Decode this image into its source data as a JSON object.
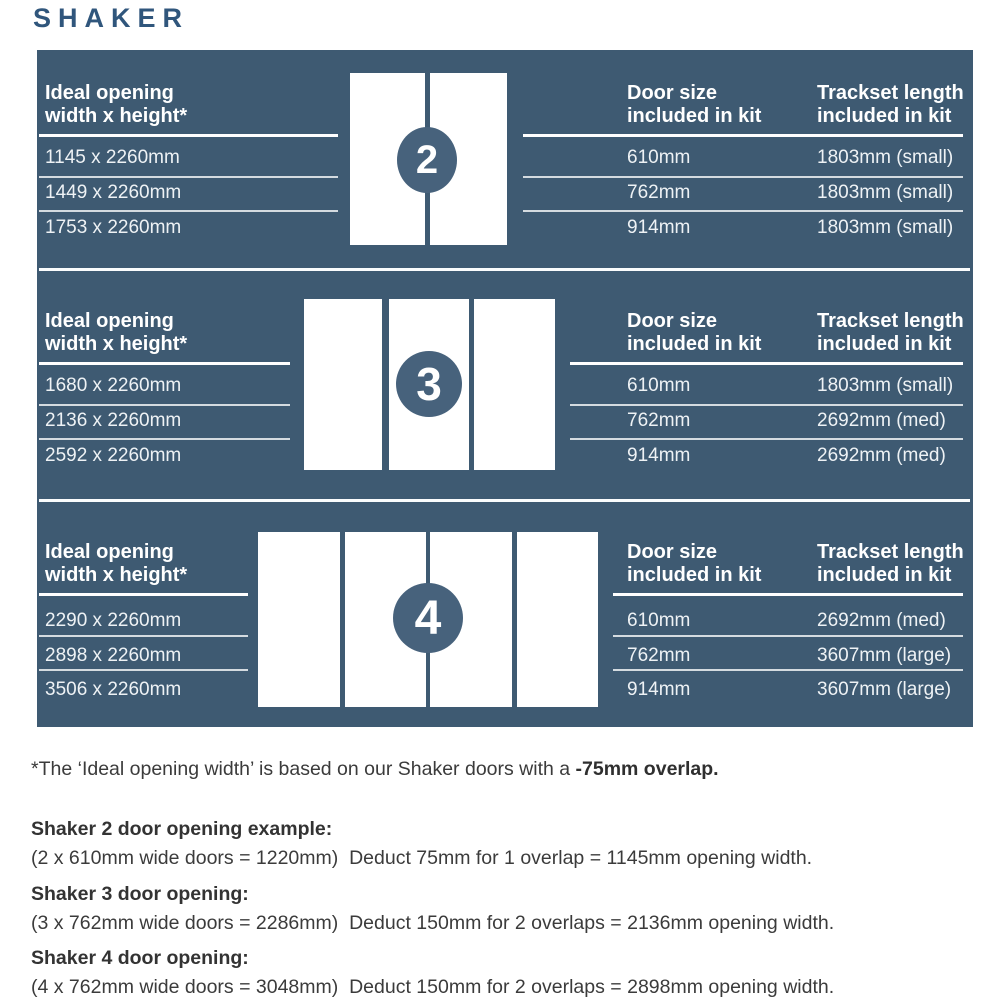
{
  "page_title": "SHAKER",
  "colors": {
    "panel_bg": "#3E5A72",
    "badge_bg": "#47627C",
    "title_color": "#30567C",
    "door_fill": "#FFFFFF",
    "body_text": "#3B3B3B"
  },
  "panel": {
    "sections": [
      {
        "badge": "2",
        "ideal_opening": {
          "header": [
            "Ideal opening",
            "width x height*"
          ],
          "rows": [
            "1145 x 2260mm",
            "1449 x 2260mm",
            "1753 x 2260mm"
          ]
        },
        "door_size": {
          "header": [
            "Door size",
            "included in kit"
          ],
          "rows": [
            "610mm",
            "762mm",
            "914mm"
          ]
        },
        "trackset": {
          "header": [
            "Trackset length",
            "included in kit"
          ],
          "rows": [
            "1803mm (small)",
            "1803mm (small)",
            "1803mm (small)"
          ]
        }
      },
      {
        "badge": "3",
        "ideal_opening": {
          "header": [
            "Ideal opening",
            "width x height*"
          ],
          "rows": [
            "1680 x 2260mm",
            "2136 x 2260mm",
            "2592 x 2260mm"
          ]
        },
        "door_size": {
          "header": [
            "Door size",
            "included in kit"
          ],
          "rows": [
            "610mm",
            "762mm",
            "914mm"
          ]
        },
        "trackset": {
          "header": [
            "Trackset length",
            "included in kit"
          ],
          "rows": [
            "1803mm (small)",
            "2692mm (med)",
            "2692mm (med)"
          ]
        }
      },
      {
        "badge": "4",
        "ideal_opening": {
          "header": [
            "Ideal opening",
            "width x height*"
          ],
          "rows": [
            "2290 x 2260mm",
            "2898 x 2260mm",
            "3506 x 2260mm"
          ]
        },
        "door_size": {
          "header": [
            "Door size",
            "included in kit"
          ],
          "rows": [
            "610mm",
            "762mm",
            "914mm"
          ]
        },
        "trackset": {
          "header": [
            "Trackset length",
            "included in kit"
          ],
          "rows": [
            "2692mm (med)",
            "3607mm (large)",
            "3607mm (large)"
          ]
        }
      }
    ]
  },
  "footnote": {
    "text": "*The ‘Ideal opening width’ is based on our Shaker doors with a ",
    "bold": "-75mm overlap."
  },
  "examples": [
    {
      "heading": "Shaker 2 door opening example:",
      "body": "(2 x 610mm wide doors = 1220mm)  Deduct 75mm for 1 overlap = 1145mm opening width."
    },
    {
      "heading": "Shaker 3 door opening:",
      "body": "(3 x 762mm wide doors = 2286mm)  Deduct 150mm for 2 overlaps = 2136mm opening width."
    },
    {
      "heading": "Shaker 4 door opening:",
      "body": "(4 x 762mm wide doors = 3048mm)  Deduct 150mm for 2 overlaps = 2898mm opening width."
    }
  ]
}
